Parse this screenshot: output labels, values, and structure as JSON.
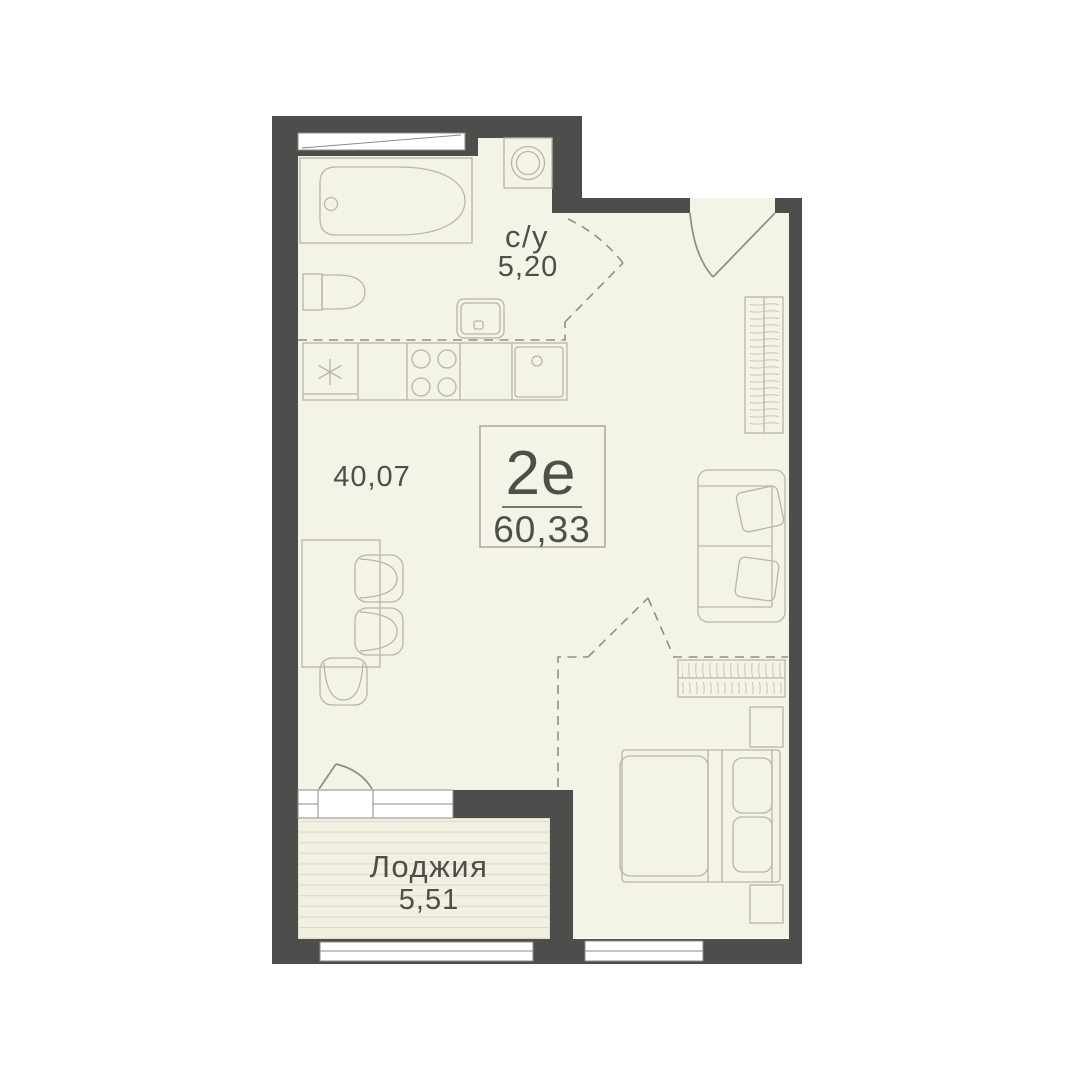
{
  "floor_plan": {
    "unit": {
      "type_label": "2е",
      "total_area": "60,33"
    },
    "rooms": {
      "bathroom": {
        "label": "с/у",
        "area": "5,20"
      },
      "living_kitchen": {
        "area": "40,07"
      },
      "loggia": {
        "label": "Лоджия",
        "area": "5,51"
      }
    },
    "colors": {
      "background": "#ffffff",
      "wall": "#4d4d4b",
      "floor": "#f4f3e7",
      "loggia_floor": "#f1f0e2",
      "furniture_line": "#b7b6a8",
      "detail_line": "#8d8d83",
      "text": "#4f4f49"
    }
  }
}
